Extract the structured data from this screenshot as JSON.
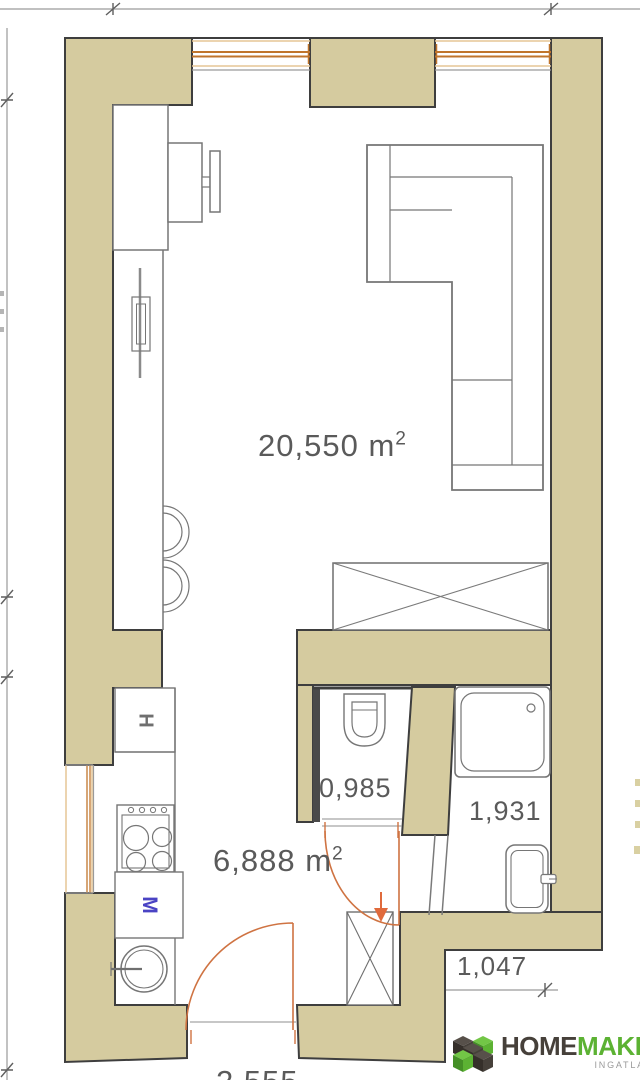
{
  "rooms": {
    "living": {
      "area": "20,550",
      "unit": "m",
      "exp": "2"
    },
    "kitchen": {
      "area": "6,888",
      "unit": "m",
      "exp": "2"
    },
    "wc": {
      "area": "0,985"
    },
    "bathroom": {
      "area": "1,931"
    }
  },
  "dimensions": {
    "bottom_right": "1,047",
    "bottom_entry_clipped": "2,555"
  },
  "appliances": {
    "fridge": "H",
    "washing_machine": "M"
  },
  "branding": {
    "name_left": "HOME",
    "name_right": "MAKER",
    "tagline": "INGATLANOK"
  },
  "colors": {
    "wall_fill": "#d5cb9f",
    "wall_outline": "#3e3e3e",
    "door_window_orange": "#cf7342",
    "label_grey": "#5a5a5a",
    "washer_letter_blue": "#4a43c4",
    "logo_dark": "#46403a",
    "logo_green": "#5cb233"
  }
}
